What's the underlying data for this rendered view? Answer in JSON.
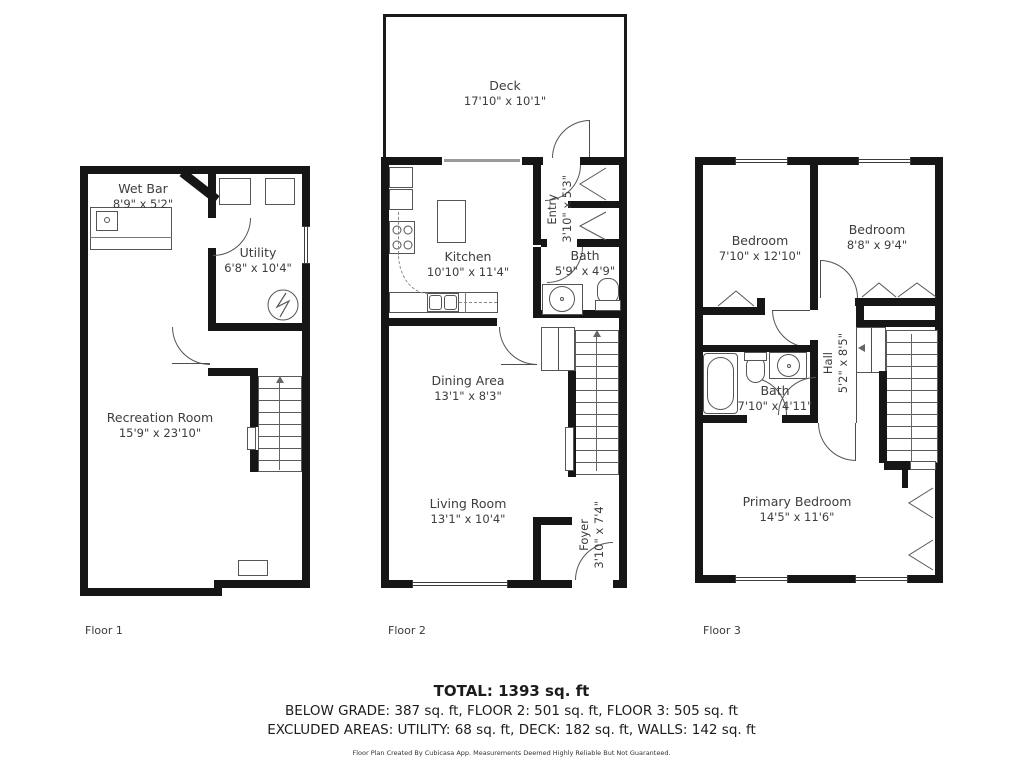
{
  "floors": {
    "f1": {
      "label": "Floor 1",
      "rooms": {
        "wet_bar": {
          "name": "Wet Bar",
          "dims": "8'9\" x 5'2\""
        },
        "utility": {
          "name": "Utility",
          "dims": "6'8\" x 10'4\""
        },
        "recreation": {
          "name": "Recreation Room",
          "dims": "15'9\" x 23'10\""
        }
      }
    },
    "f2": {
      "label": "Floor 2",
      "rooms": {
        "deck": {
          "name": "Deck",
          "dims": "17'10\" x 10'1\""
        },
        "kitchen": {
          "name": "Kitchen",
          "dims": "10'10\" x 11'4\""
        },
        "entry": {
          "name": "Entry",
          "dims": "3'10\" x 5'3\""
        },
        "bath": {
          "name": "Bath",
          "dims": "5'9\" x 4'9\""
        },
        "dining": {
          "name": "Dining Area",
          "dims": "13'1\" x 8'3\""
        },
        "living": {
          "name": "Living Room",
          "dims": "13'1\" x 10'4\""
        },
        "foyer": {
          "name": "Foyer",
          "dims": "3'10\" x 7'4\""
        }
      }
    },
    "f3": {
      "label": "Floor 3",
      "rooms": {
        "bedroom_left": {
          "name": "Bedroom",
          "dims": "7'10\" x 12'10\""
        },
        "bedroom_right": {
          "name": "Bedroom",
          "dims": "8'8\" x 9'4\""
        },
        "bath": {
          "name": "Bath",
          "dims": "7'10\" x 4'11\""
        },
        "hall": {
          "name": "Hall",
          "dims": "5'2\" x 8'5\""
        },
        "primary": {
          "name": "Primary Bedroom",
          "dims": "14'5\" x 11'6\""
        }
      }
    }
  },
  "summary": {
    "total": "TOTAL: 1393 sq. ft",
    "breakdown": "BELOW GRADE: 387 sq. ft, FLOOR 2: 501 sq. ft, FLOOR 3: 505 sq. ft",
    "excluded": "EXCLUDED AREAS: UTILITY: 68 sq. ft, DECK: 182 sq. ft, WALLS: 142 sq. ft",
    "disclaimer": "Floor Plan Created By Cubicasa App. Measurements Deemed Highly Reliable But Not Guaranteed."
  },
  "colors": {
    "wall": "#161616",
    "line": "#4d4d4d",
    "text": "#3d3d3d"
  }
}
